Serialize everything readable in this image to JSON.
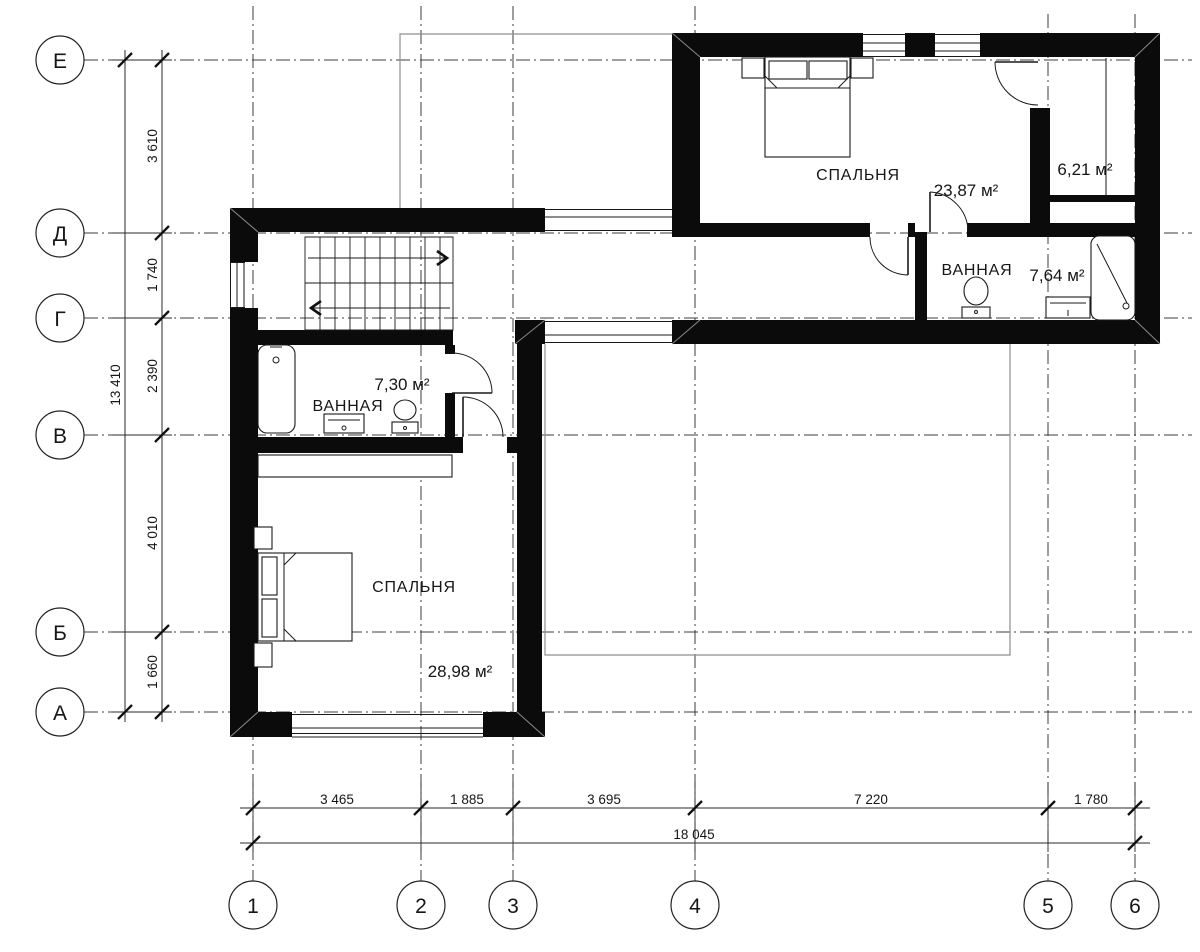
{
  "axes": {
    "rows": [
      "Е",
      "Д",
      "Г",
      "В",
      "Б",
      "А"
    ],
    "cols": [
      "1",
      "2",
      "3",
      "4",
      "5",
      "6"
    ]
  },
  "dims": {
    "left": [
      "3 610",
      "1 740",
      "2 390",
      "4 010",
      "1 660"
    ],
    "left_total": "13 410",
    "bottom": [
      "3 465",
      "1 885",
      "3 695",
      "7 220",
      "1 780"
    ],
    "bottom_total": "18 045"
  },
  "rooms": {
    "bedroom_top": {
      "name": "СПАЛЬНЯ",
      "area": "23,87 м²"
    },
    "closet": {
      "area": "6,21 м²"
    },
    "bath_top": {
      "name": "ВАННАЯ",
      "area": "7,64 м²"
    },
    "bath_bottom": {
      "name": "ВАННАЯ",
      "area": "7,30 м²"
    },
    "bedroom_bottom": {
      "name": "СПАЛЬНЯ",
      "area": "28,98 м²"
    }
  }
}
